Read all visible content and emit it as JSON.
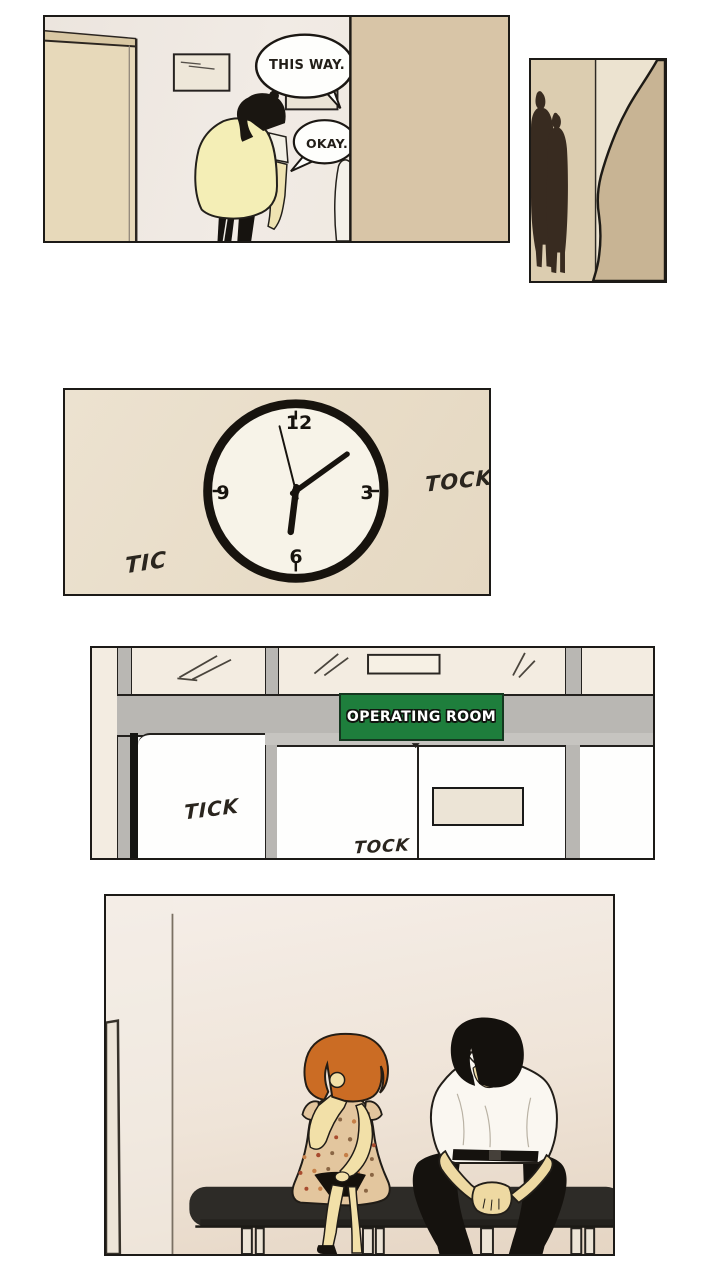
{
  "page": {
    "background": "#ffffff"
  },
  "panels": {
    "hallway": {
      "dialogue": {
        "this_way": "THIS WAY.",
        "okay": "OKAY."
      }
    },
    "clock": {
      "numerals": {
        "twelve": "12",
        "three": "3",
        "six": "6",
        "nine": "9"
      },
      "sfx": {
        "tic": "TIC",
        "tock": "TOCK"
      },
      "hands": {
        "hour_deg": 187,
        "minute_deg": 54,
        "second_deg": -14,
        "hour_transform": "rotate(187)",
        "minute_transform": "rotate(54)",
        "second_transform": "rotate(-14)"
      }
    },
    "operating_room": {
      "sign": "OPERATING ROOM",
      "sfx": {
        "tick": "TICK",
        "tock": "TOCK"
      }
    }
  },
  "colors": {
    "sign_green": "#1e7e3c",
    "coat_yellow": "#f4eeb6",
    "hair_orange": "#cb6c24",
    "foreground_wall_tan": "#d8c5a7",
    "bench_black": "#2d2b27"
  }
}
